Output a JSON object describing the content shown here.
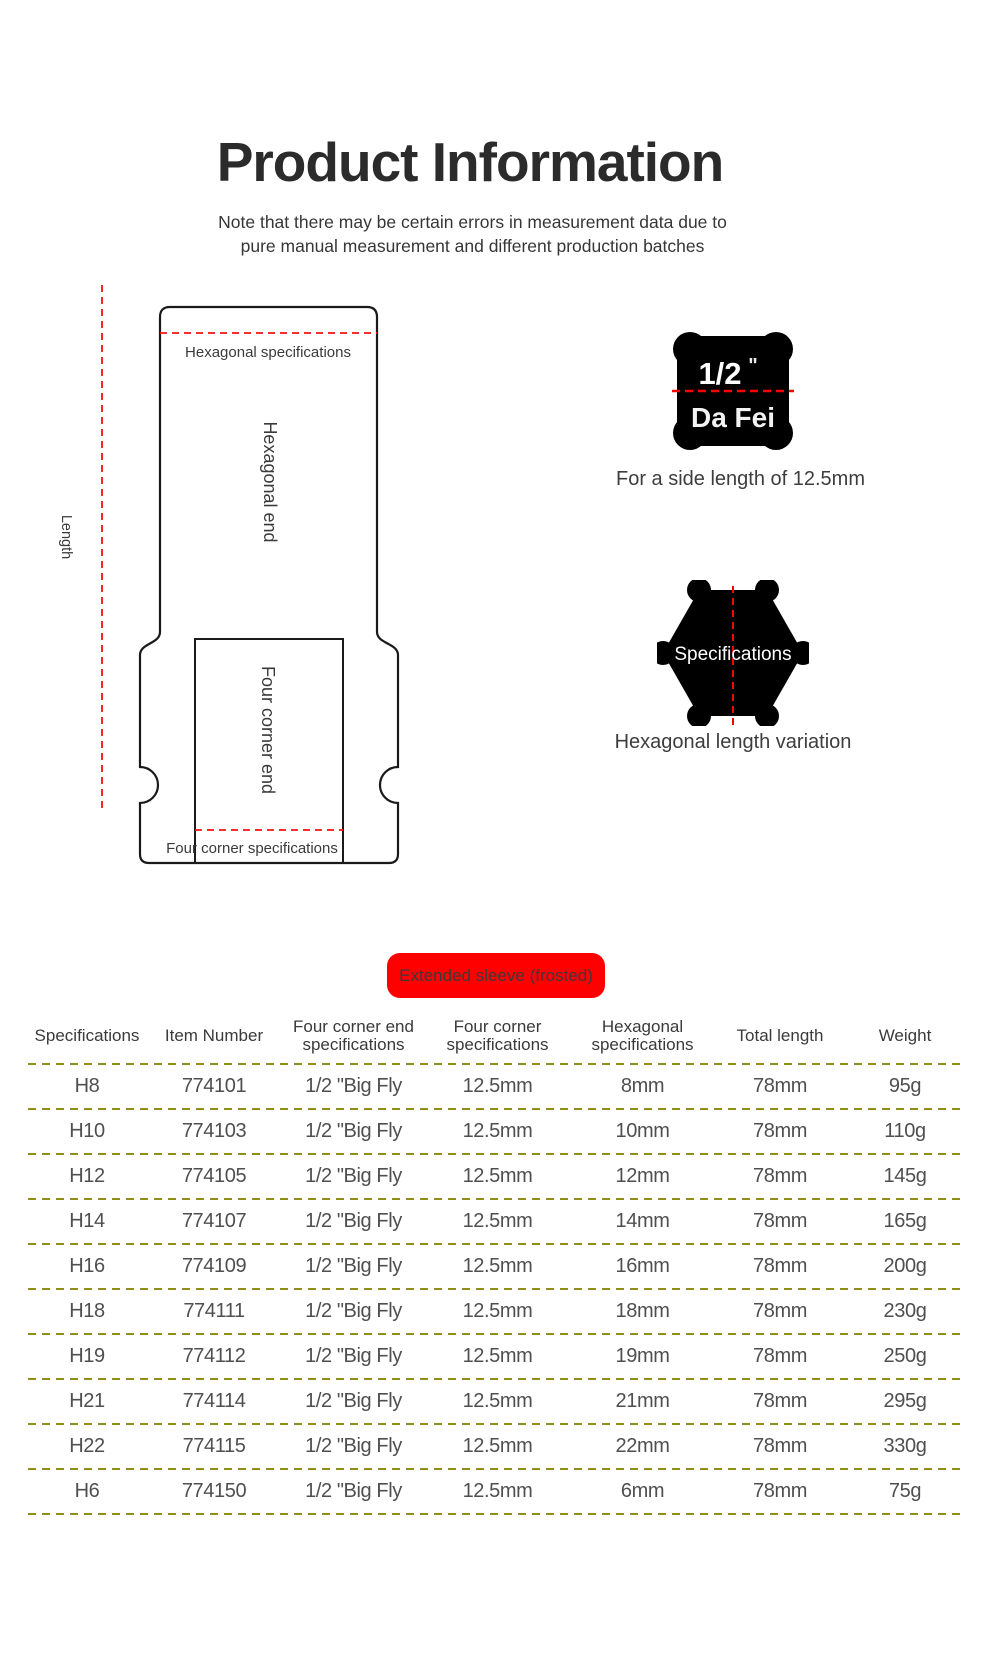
{
  "header": {
    "title": "Product Information",
    "subtitle": "Note that there may be certain errors in measurement data due to\npure manual measurement and different production batches"
  },
  "diagram": {
    "length_label": "Length",
    "hexagonal_spec_label": "Hexagonal specifications",
    "hexagonal_end_label": "Hexagonal end",
    "four_corner_end_label": "Four corner end",
    "four_corner_spec_label": "Four corner specifications"
  },
  "drive_badge": {
    "size": "1/2",
    "inch_mark": "\"",
    "brand": "Da Fei",
    "caption": "For a side length of 12.5mm"
  },
  "hex_badge": {
    "label": "Specifications",
    "caption": "Hexagonal length variation"
  },
  "sleeve_badge": {
    "label": "Extended sleeve (frosted)"
  },
  "table": {
    "columns": [
      "Specifications",
      "Item Number",
      "Four corner end\nspecifications",
      "Four corner\nspecifications",
      "Hexagonal\nspecifications",
      "Total length",
      "Weight"
    ],
    "rows": [
      [
        "H8",
        "774101",
        "1/2 \"Big Fly",
        "12.5mm",
        "8mm",
        "78mm",
        "95g"
      ],
      [
        "H10",
        "774103",
        "1/2 \"Big Fly",
        "12.5mm",
        "10mm",
        "78mm",
        "110g"
      ],
      [
        "H12",
        "774105",
        "1/2 \"Big Fly",
        "12.5mm",
        "12mm",
        "78mm",
        "145g"
      ],
      [
        "H14",
        "774107",
        "1/2 \"Big Fly",
        "12.5mm",
        "14mm",
        "78mm",
        "165g"
      ],
      [
        "H16",
        "774109",
        "1/2 \"Big Fly",
        "12.5mm",
        "16mm",
        "78mm",
        "200g"
      ],
      [
        "H18",
        "774111",
        "1/2 \"Big Fly",
        "12.5mm",
        "18mm",
        "78mm",
        "230g"
      ],
      [
        "H19",
        "774112",
        "1/2 \"Big Fly",
        "12.5mm",
        "19mm",
        "78mm",
        "250g"
      ],
      [
        "H21",
        "774114",
        "1/2 \"Big Fly",
        "12.5mm",
        "21mm",
        "78mm",
        "295g"
      ],
      [
        "H22",
        "774115",
        "1/2 \"Big Fly",
        "12.5mm",
        "22mm",
        "78mm",
        "330g"
      ],
      [
        "H6",
        "774150",
        "1/2 \"Big Fly",
        "12.5mm",
        "6mm",
        "78mm",
        "75g"
      ]
    ]
  },
  "colors": {
    "accent_red": "#ff0000",
    "badge_black": "#000000",
    "separator_olive": "#8e8e19",
    "outline_black": "#1a1a1a",
    "text_dark": "#2b2b2b",
    "text_gray": "#4f4f4f"
  }
}
